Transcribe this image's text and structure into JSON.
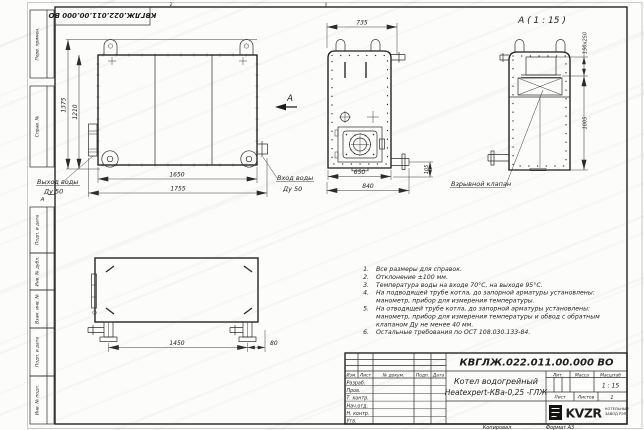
{
  "sheet": {
    "doc_number_top": "КВГЛЖ.022.011.00.000 ВО",
    "zone_top": "2",
    "zone_left": "А"
  },
  "margin_stamps": [
    "Перв. примен.",
    "Справ. №",
    "Подп. и дата",
    "Инв. № дубл.",
    "Взам. инв. №",
    "Подп. и дата",
    "Инв. № подл."
  ],
  "views": {
    "front": {
      "dim_height": "1375",
      "dim_height_inner": "1210",
      "dim_length": "1650",
      "dim_length_overall": "1755",
      "outlet_line1": "Выход воды",
      "outlet_line2": "Ду 50",
      "inlet_line1": "Вход воды",
      "inlet_line2": "Ду 50",
      "arrow_label": "А"
    },
    "side": {
      "dim_top": "735",
      "dim_body": "650",
      "dim_overall": "840",
      "dim_pipe": "105"
    },
    "detail": {
      "title": "А ( 1 : 15 )",
      "dim_valve": "150x250",
      "dim_height": "1005",
      "callout": "Взрывной клапан"
    },
    "bottom": {
      "dim_span": "1450",
      "dim_offset": "80"
    }
  },
  "notes": [
    {
      "num": "1.",
      "text": "Все размеры для справок."
    },
    {
      "num": "2.",
      "text": "Отклонение ±100 мм."
    },
    {
      "num": "3.",
      "text": "Температура воды на входе 70°С, на выходе 95°С."
    },
    {
      "num": "4.",
      "text": "На подводящей трубе котла, до запорной арматуры установлены:"
    },
    {
      "num": "",
      "text": "манометр, прибор для измерения температуры."
    },
    {
      "num": "5.",
      "text": "На отводящей трубе котла, до запорной арматуры установлены:"
    },
    {
      "num": "",
      "text": "манометр, прибор для измерения температуры и обвод с обратным"
    },
    {
      "num": "",
      "text": "клапаном Ду не менее 40 мм."
    },
    {
      "num": "6.",
      "text": "Остальные требования по ОСТ 108.030.133-84."
    }
  ],
  "title_block": {
    "doc_number": "КВГЛЖ.022.011.00.000 ВО",
    "product_name_line1": "Котел водогрейный",
    "product_name_line2": "Heatexpert-КВа-0,25 -ГЛЖ",
    "col_izm": "Изм.",
    "col_list": "Лист",
    "col_doc": "№ докум.",
    "col_podp": "Подп.",
    "col_data": "Дата",
    "rows": [
      "Разраб.",
      "Пров.",
      "Т. контр.",
      "Нач.отд.",
      "Н. контр.",
      "Утв."
    ],
    "lit_label": "Лит.",
    "mass_label": "Масса",
    "scale_label": "Масштаб",
    "scale_value": "1 : 15",
    "sheet_label": "Лист",
    "sheets_label": "Листов",
    "sheets_value": "1",
    "logo_text": "KVZR",
    "company_line1": "КОТЕЛЬНЫЙ",
    "company_line2": "ЗАВОД РЭП"
  },
  "footer": {
    "copied": "Копировал",
    "format": "Формат А3"
  }
}
